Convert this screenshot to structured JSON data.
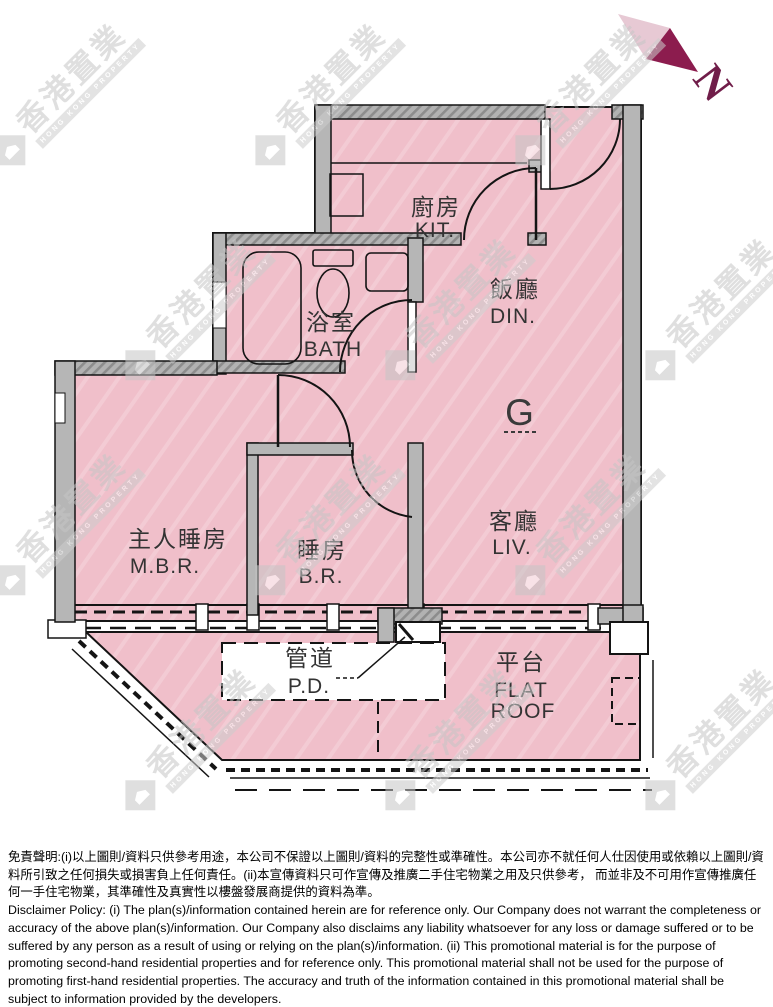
{
  "page": {
    "width": 773,
    "height": 1007,
    "background": "#ffffff"
  },
  "compass": {
    "north_label": "N"
  },
  "unit": {
    "label": "G"
  },
  "rooms": {
    "kitchen": {
      "zh": "廚房",
      "en": "KIT."
    },
    "dining": {
      "zh": "飯廳",
      "en": "DIN."
    },
    "bath": {
      "zh": "浴室",
      "en": "BATH"
    },
    "master_bedroom": {
      "zh": "主人睡房",
      "en": "M.B.R."
    },
    "bedroom": {
      "zh": "睡房",
      "en": "B.R."
    },
    "living": {
      "zh": "客廳",
      "en": "LIV."
    },
    "pipe_duct": {
      "zh": "管道",
      "en": "P.D."
    },
    "flat_roof": {
      "zh": "平台",
      "en_line1": "FLAT",
      "en_line2": "ROOF"
    }
  },
  "watermark": {
    "logo_zh": "香港置業",
    "logo_en": "HONG KONG PROPERTY"
  },
  "colors": {
    "floor_pink": "#f0bfca",
    "floor_pink_streak": "#f3cbd4",
    "wall_gray": "#b6b6b6",
    "line": "#141414",
    "compass_dark": "#8c1c4e",
    "compass_light": "#e7c9d4",
    "watermark_gray": "#c6c6c6"
  },
  "disclaimer": {
    "zh": "免責聲明:(i)以上圖則/資料只供參考用途，本公司不保證以上圖則/資料的完整性或準確性。本公司亦不就任何人仕因使用或依賴以上圖則/資料所引致之任何損失或損害負上任何責任。(ii)本宣傳資料只可作宣傳及推廣二手住宅物業之用及只供參考， 而並非及不可用作宣傳推廣任何一手住宅物業，其準確性及真實性以樓盤發展商提供的資料為準。",
    "en": "Disclaimer Policy: (i) The plan(s)/information contained herein are for reference only. Our Company does not warrant the completeness or accuracy of the above plan(s)/information. Our Company also disclaims any liability whatsoever for any loss or damage suffered or to be suffered by any person as a result of using or relying on the plan(s)/information. (ii) This promotional material is for the purpose of promoting second-hand residential properties and for reference only. This promotional material shall not be used for the purpose of promoting first-hand residential properties. The accuracy and truth of the information contained in this promotional material shall be subject to information provided by the developers."
  }
}
